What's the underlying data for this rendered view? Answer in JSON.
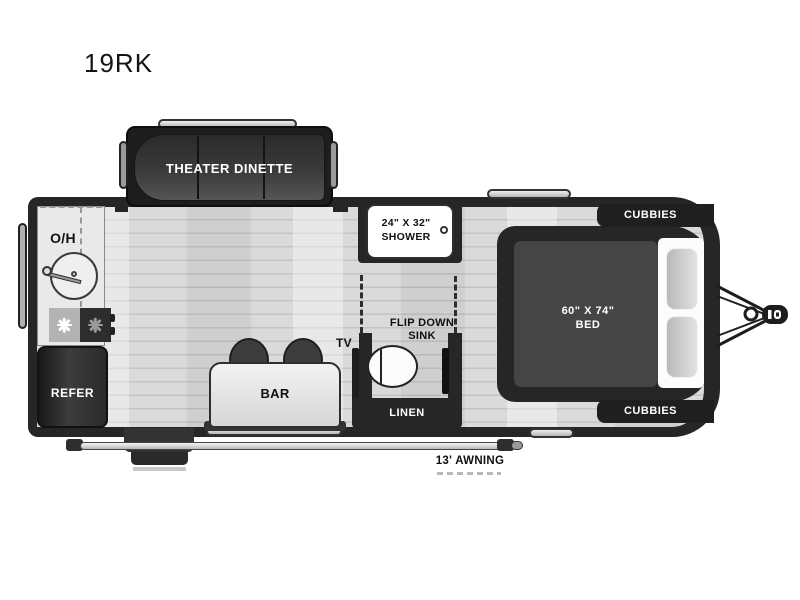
{
  "title": "19RK",
  "colors": {
    "wall": "#262626",
    "floor": "#d8d8d8",
    "fixture_light": "#e9e9e9",
    "text_dark": "#111111",
    "text_light": "#ffffff"
  },
  "floorplan": {
    "slideout_label": "THEATER DINETTE",
    "kitchen": {
      "overhead": "O/H",
      "refrigerator": "REFER"
    },
    "bath": {
      "shower_size": "24\" X 32\"",
      "shower": "SHOWER",
      "flip_sink_line1": "FLIP DOWN",
      "flip_sink_line2": "SINK",
      "linen": "LINEN"
    },
    "living": {
      "tv": "TV",
      "bar": "BAR"
    },
    "bedroom": {
      "bed_size": "60\" X 74\"",
      "bed": "BED",
      "cubbies_top": "CUBBIES",
      "cubbies_bottom": "CUBBIES"
    },
    "exterior": {
      "awning": "13' AWNING"
    }
  }
}
